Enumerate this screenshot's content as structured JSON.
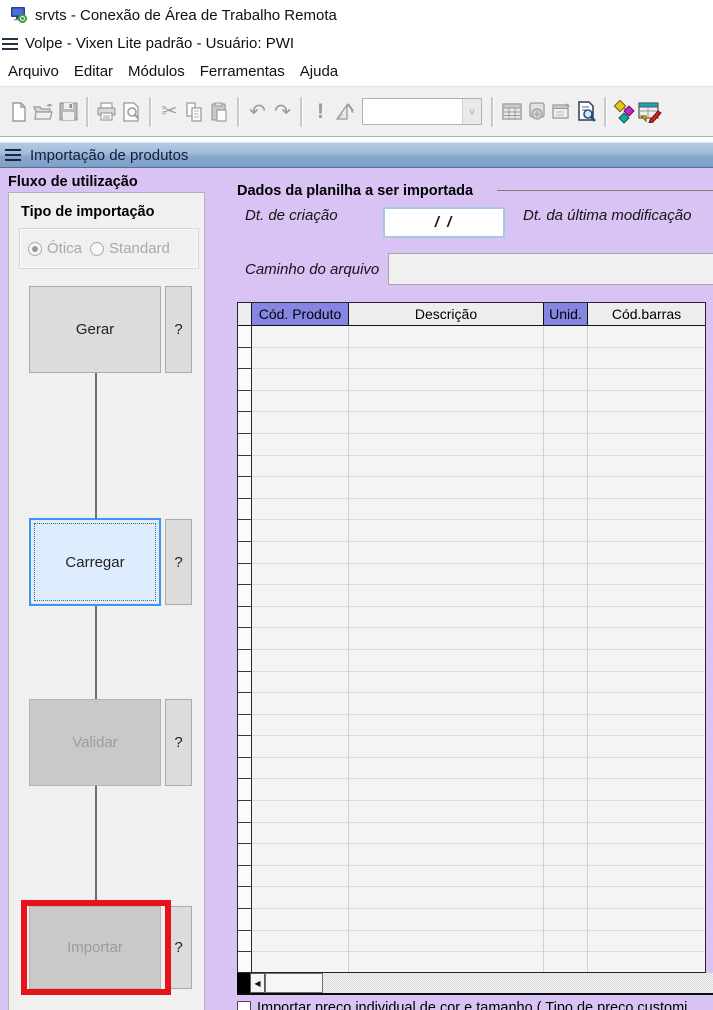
{
  "rdp_title": {
    "label": "srvts - Conexão de Área de Trabalho Remota",
    "icon": "remote-desktop-icon"
  },
  "app_title": {
    "label": "Volpe - Vixen Lite padrão - Usuário: PWI",
    "icon": "hamburger-icon"
  },
  "menu": {
    "items": [
      "Arquivo",
      "Editar",
      "Módulos",
      "Ferramentas",
      "Ajuda"
    ]
  },
  "toolbar": {
    "icons": [
      "new-document",
      "open-folder",
      "save",
      "print",
      "print-preview",
      "cut",
      "copy",
      "paste",
      "undo",
      "redo",
      "execute",
      "design-ruler",
      "grid-view",
      "calculator",
      "properties",
      "search-document",
      "sort-flow",
      "grid-edit"
    ],
    "combo_value": ""
  },
  "window_bar": {
    "title": "Importação de produtos",
    "icon": "hamburger-icon"
  },
  "flow": {
    "title": "Fluxo de utilização",
    "import_type": {
      "title": "Tipo de importação",
      "options": [
        {
          "label": "Ótica",
          "selected": true,
          "enabled": false
        },
        {
          "label": "Standard",
          "selected": false,
          "enabled": false
        }
      ]
    },
    "help_label": "?",
    "buttons": [
      {
        "label": "Gerar",
        "state": "normal"
      },
      {
        "label": "Carregar",
        "state": "focused"
      },
      {
        "label": "Validar",
        "state": "disabled"
      },
      {
        "label": "Importar",
        "state": "disabled",
        "annotation": "red-highlight-rectangle"
      }
    ]
  },
  "sheet": {
    "title": "Dados da planilha a ser importada",
    "creation_date_label": "Dt. de criação",
    "creation_date_value": "/    /",
    "modified_date_label": "Dt. da última modificação",
    "file_path_label": "Caminho do arquivo",
    "file_path_value": "",
    "table": {
      "columns": [
        "Cód. Produto",
        "Descrição",
        "Unid.",
        "Cód.barras"
      ],
      "highlighted_columns": [
        "Cód. Produto",
        "Unid."
      ],
      "row_count": 30,
      "rows": []
    },
    "checkbox_label": "Importar preço individual de cor e tamanho ( Tipo de preço customi",
    "checkbox_checked": false
  },
  "colors": {
    "content_background": "#d9c3f4",
    "window_bar_gradient_top": "#b5cbe4",
    "window_bar_gradient_bottom": "#7f9fc6",
    "panel_background": "#f0f0f0",
    "header_highlight": "#8686e2",
    "focused_button_border": "#3e96e8",
    "focused_button_fill": "#ddedfd",
    "annotation_red": "#e6131a"
  }
}
